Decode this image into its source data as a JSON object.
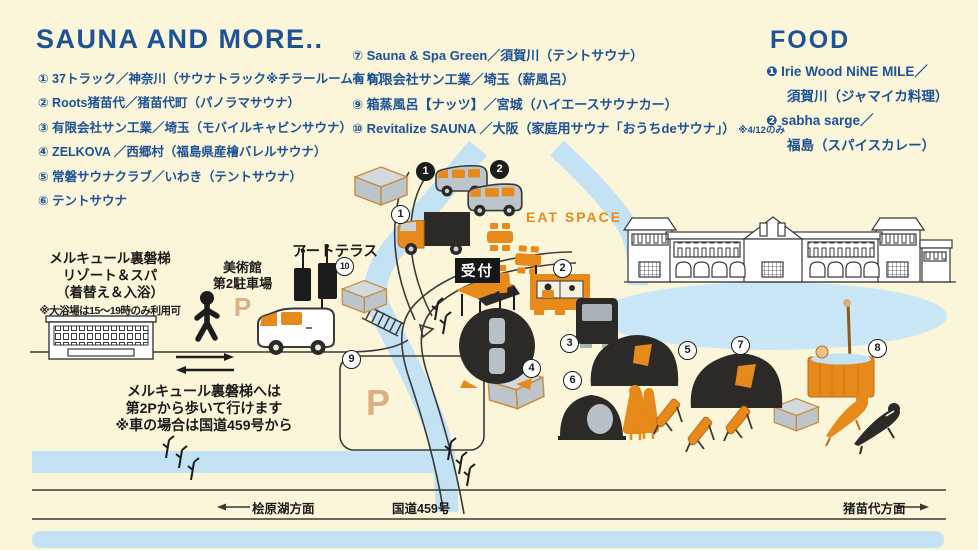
{
  "palette": {
    "bg": "#FBF6D9",
    "blue": "#1D5296",
    "orange": "#E8891B",
    "dark": "#2B2A27",
    "river": "#C3E2F4",
    "lake": "#CAE7F8",
    "gray": "#BCC5C9",
    "grayTop": "#D3DADD",
    "tan": "#D9B183",
    "line": "#3A3A38"
  },
  "legend": {
    "sauna": {
      "title": "SAUNA AND MORE..",
      "items": [
        "① 37トラック／神奈川（サウナトラック※チラールーム有り）",
        "② Roots猪苗代／猪苗代町（パノラマサウナ）",
        "③ 有限会社サン工業／埼玉（モバイルキャビンサウナ）",
        "④ ZELKOVA ／西郷村（福島県産檜バレルサウナ）",
        "⑤ 常磐サウナクラブ／いわき（テントサウナ）",
        "⑥ テントサウナ",
        "⑦ Sauna & Spa Green／須賀川（テントサウナ）",
        "⑧ 有限会社サン工業／埼玉（薪風呂）",
        "⑨ 箱蒸風呂【ナッツ】／宮城（ハイエースサウナカー）",
        "⑩ Revitalize SAUNA ／大阪（家庭用サウナ「おうちdeサウナ」）"
      ],
      "item10_note": "※4/12のみ"
    },
    "food": {
      "title": "FOOD",
      "items": [
        {
          "line1": "❶ Irie Wood NiNE MILE／",
          "line2": "須賀川（ジャマイカ料理）"
        },
        {
          "line1": "❷ sabha sarge／",
          "line2": "福島（スパイスカレー）"
        }
      ]
    }
  },
  "map": {
    "hotel": {
      "line1": "メルキュール裏磐梯",
      "line2": "リゾート＆スパ",
      "line3": "（着替え＆入浴）",
      "note": "※大浴場は15～19時のみ利用可"
    },
    "museum_parking": {
      "line1": "美術館",
      "line2": "第2駐車場",
      "p": "P"
    },
    "art_terrace": "アートテラス",
    "walk_note": {
      "line1": "メルキュール裏磐梯へは",
      "line2": "第2Pから歩いて行けます",
      "line3": "※車の場合は国道459号から"
    },
    "reception": "受付",
    "eat_space": "EAT SPACE",
    "parking_p": "P",
    "road": {
      "left": "桧原湖方面",
      "center": "国道459号",
      "right": "猪苗代方面"
    },
    "markers": {
      "outlined": [
        "1",
        "2",
        "3",
        "4",
        "5",
        "6",
        "7",
        "8",
        "9",
        "10"
      ],
      "filled": [
        "1",
        "2"
      ]
    }
  }
}
